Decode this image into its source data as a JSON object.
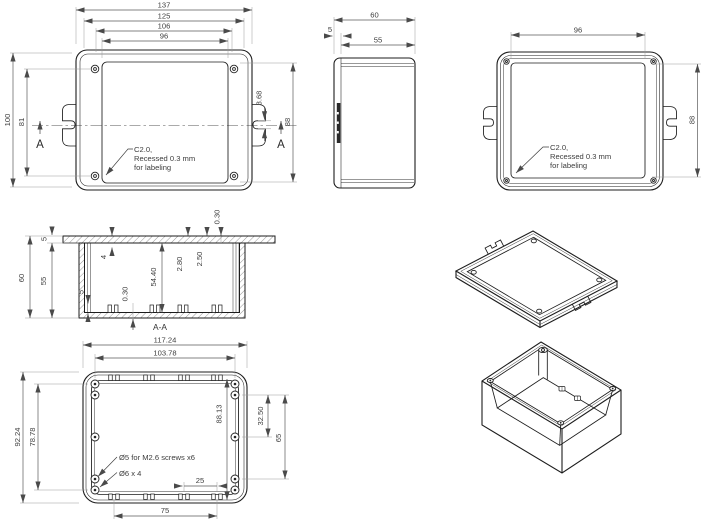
{
  "note": {
    "l1": "C2.0,",
    "l2": "Recessed 0.3 mm",
    "l3": "for labeling"
  },
  "views": {
    "top": {
      "dim_137": "137",
      "dim_125": "125",
      "dim_106": "106",
      "dim_96": "96",
      "dim_100": "100",
      "dim_81": "81",
      "dim_88": "88",
      "dim_slot": "3.68",
      "section_marker": "A"
    },
    "side": {
      "dim_60": "60",
      "dim_5": "5",
      "dim_55": "55"
    },
    "front": {
      "dim_96": "96",
      "dim_88": "88"
    },
    "section": {
      "label": "A-A",
      "dim_60": "60",
      "dim_55": "55",
      "dim_5_lid": "5",
      "dim_4": "4",
      "dim_5440": "54.40",
      "dim_280": "2.80",
      "dim_250": "2.50",
      "dim_030_top": "0.30",
      "dim_5_boss": "5",
      "dim_030_bottom": "0.30"
    },
    "bottom": {
      "dim_11724": "117.24",
      "dim_10378": "103.78",
      "dim_9224": "92.24",
      "dim_7878": "78.78",
      "dim_8813": "88.13",
      "dim_3250": "32.50",
      "dim_65": "65",
      "dim_25": "25",
      "dim_75": "75",
      "note_screws": "Ø5 for M2.6 screws x6",
      "note_posts": "Ø6 x 4"
    }
  }
}
